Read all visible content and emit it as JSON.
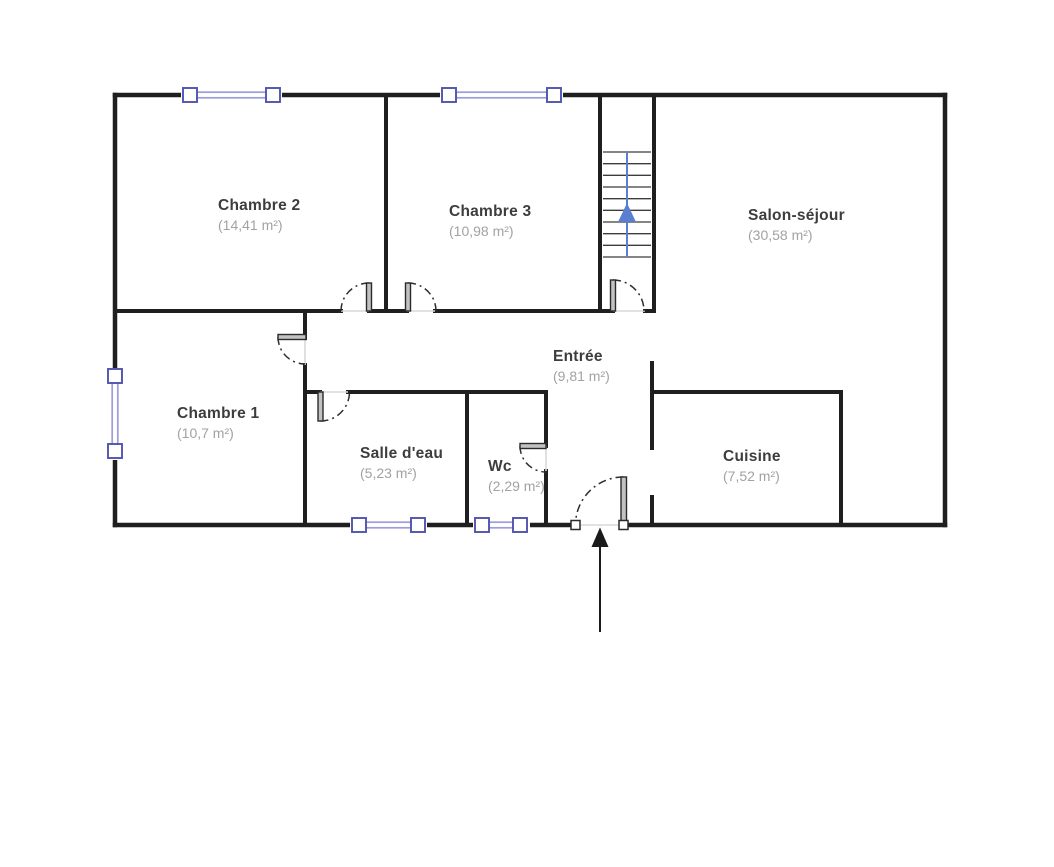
{
  "plan": {
    "rooms": {
      "chambre2": {
        "name": "Chambre 2",
        "area": "(14,41 m²)"
      },
      "chambre3": {
        "name": "Chambre 3",
        "area": "(10,98 m²)"
      },
      "salon": {
        "name": "Salon-séjour",
        "area": "(30,58 m²)"
      },
      "chambre1": {
        "name": "Chambre 1",
        "area": "(10,7 m²)"
      },
      "entree": {
        "name": "Entrée",
        "area": "(9,81 m²)"
      },
      "salle_eau": {
        "name": "Salle d'eau",
        "area": "(5,23 m²)"
      },
      "wc": {
        "name": "Wc",
        "area": "(2,29 m²)"
      },
      "cuisine": {
        "name": "Cuisine",
        "area": "(7,52 m²)"
      }
    },
    "colors": {
      "wall": "#1f1f1f",
      "window_frame": "#4f53ae",
      "window_rail": "#9b9edb",
      "stair_arrow": "#5b7fd0",
      "entrance_arrow": "#1a1a1a",
      "door_threshold": "#d9d9d9",
      "room_name_text": "#3d3d3d",
      "room_area_text": "#a2a2a2"
    }
  }
}
